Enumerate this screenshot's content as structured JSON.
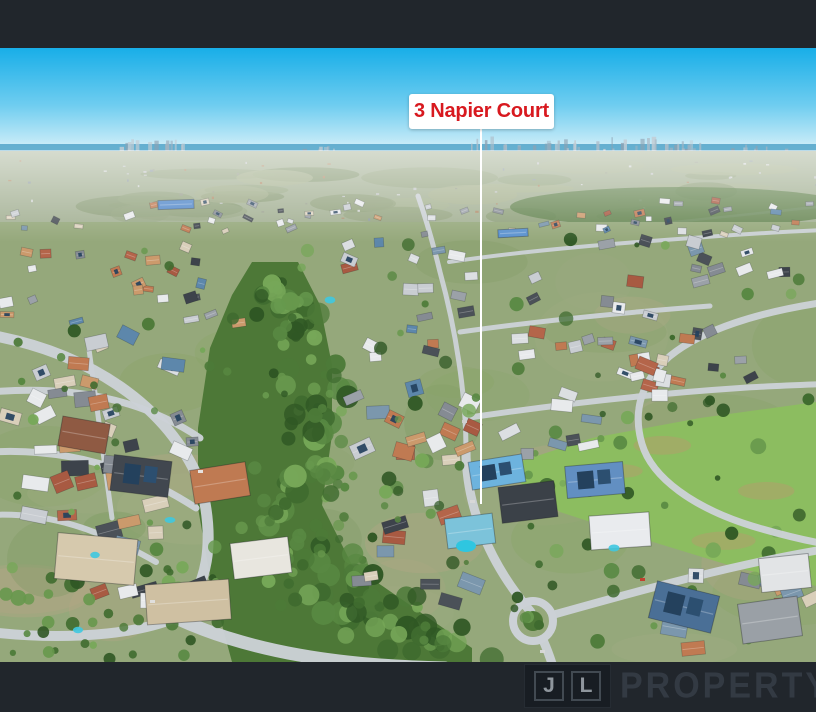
{
  "photo": {
    "kind": "aerial-suburb-drone-photo",
    "alt": "Aerial view of a suburban neighbourhood with a treed reserve, winding streets, a roundabout and a distant city skyline on the horizon",
    "colors": {
      "frame_bar": "#21262c",
      "sky_top": "#18aee8",
      "sky_mid": "#6fcdf0",
      "sky_horizon": "#d9f1f9",
      "sea": "#5aa9cb",
      "distant_land": "#a3b093",
      "suburb_base": "#95a87b",
      "reserve_green": "#4d7837",
      "park_green": "#8cbd60",
      "road": "#ccd1d6"
    }
  },
  "marker": {
    "label": "3 Napier Court",
    "text_color": "#d8191f",
    "box_color": "#ffffff",
    "line_color": "#ffffff"
  },
  "watermark": {
    "initial_1": "J",
    "initial_2": "L",
    "word": "PROPERTY"
  }
}
